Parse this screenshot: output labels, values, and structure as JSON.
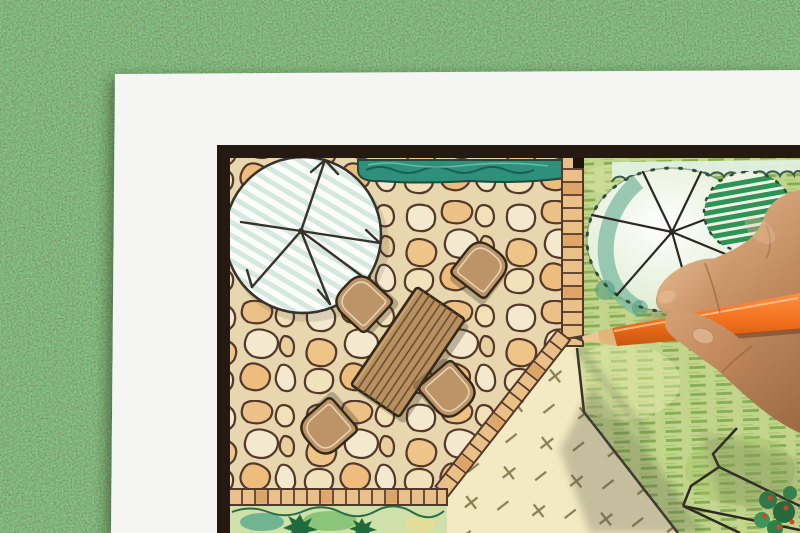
{
  "scene": {
    "subject": "hand drawing a garden landscape design plan with an orange colored pencil on white paper lying on green grass",
    "colors": {
      "grass-base": "#4a7d42",
      "paper": "#f5f6f4",
      "plan-border": "#241a11",
      "stone-grout": "#e7d6ae",
      "stone-cream": "#f4e9cf",
      "stone-orange": "#ebc187",
      "stone-line": "#54392a",
      "hedge-teal": "#2e8f7a",
      "hedge-ink": "#1c4a3d",
      "hedge-mint": "#dff0e2",
      "lawn-green": "#c3d58c",
      "lawn-stroke": "#85ae54",
      "sand": "#f3e9c2",
      "sand-mark": "#8a7f52",
      "bed-green": "#cfe0a8",
      "conifer": "#1f6b3d",
      "tree-hatch": "#cde4da",
      "ink": "#37332b",
      "furniture-tan": "#b8905f",
      "furniture-ink": "#342818",
      "chair-tan": "#bd9467",
      "brick": "#e9c088",
      "brick-dark": "#d89c5c",
      "tree-mint": "#d8e8c8",
      "tree-teal": "#7cbaa2",
      "stripe-green": "#2f9356",
      "plant-red": "#cc4a28",
      "pencil-orange": "#f26f1c",
      "pencil-light": "#ff9447",
      "pencil-deep": "#c4540e",
      "pencil-wood": "#ecc693",
      "pencil-lead": "#4a3d33",
      "skin-light": "#e0b186",
      "skin": "#c08a5e",
      "skin-dark": "#99663f",
      "shadow": "#4f5242"
    }
  }
}
